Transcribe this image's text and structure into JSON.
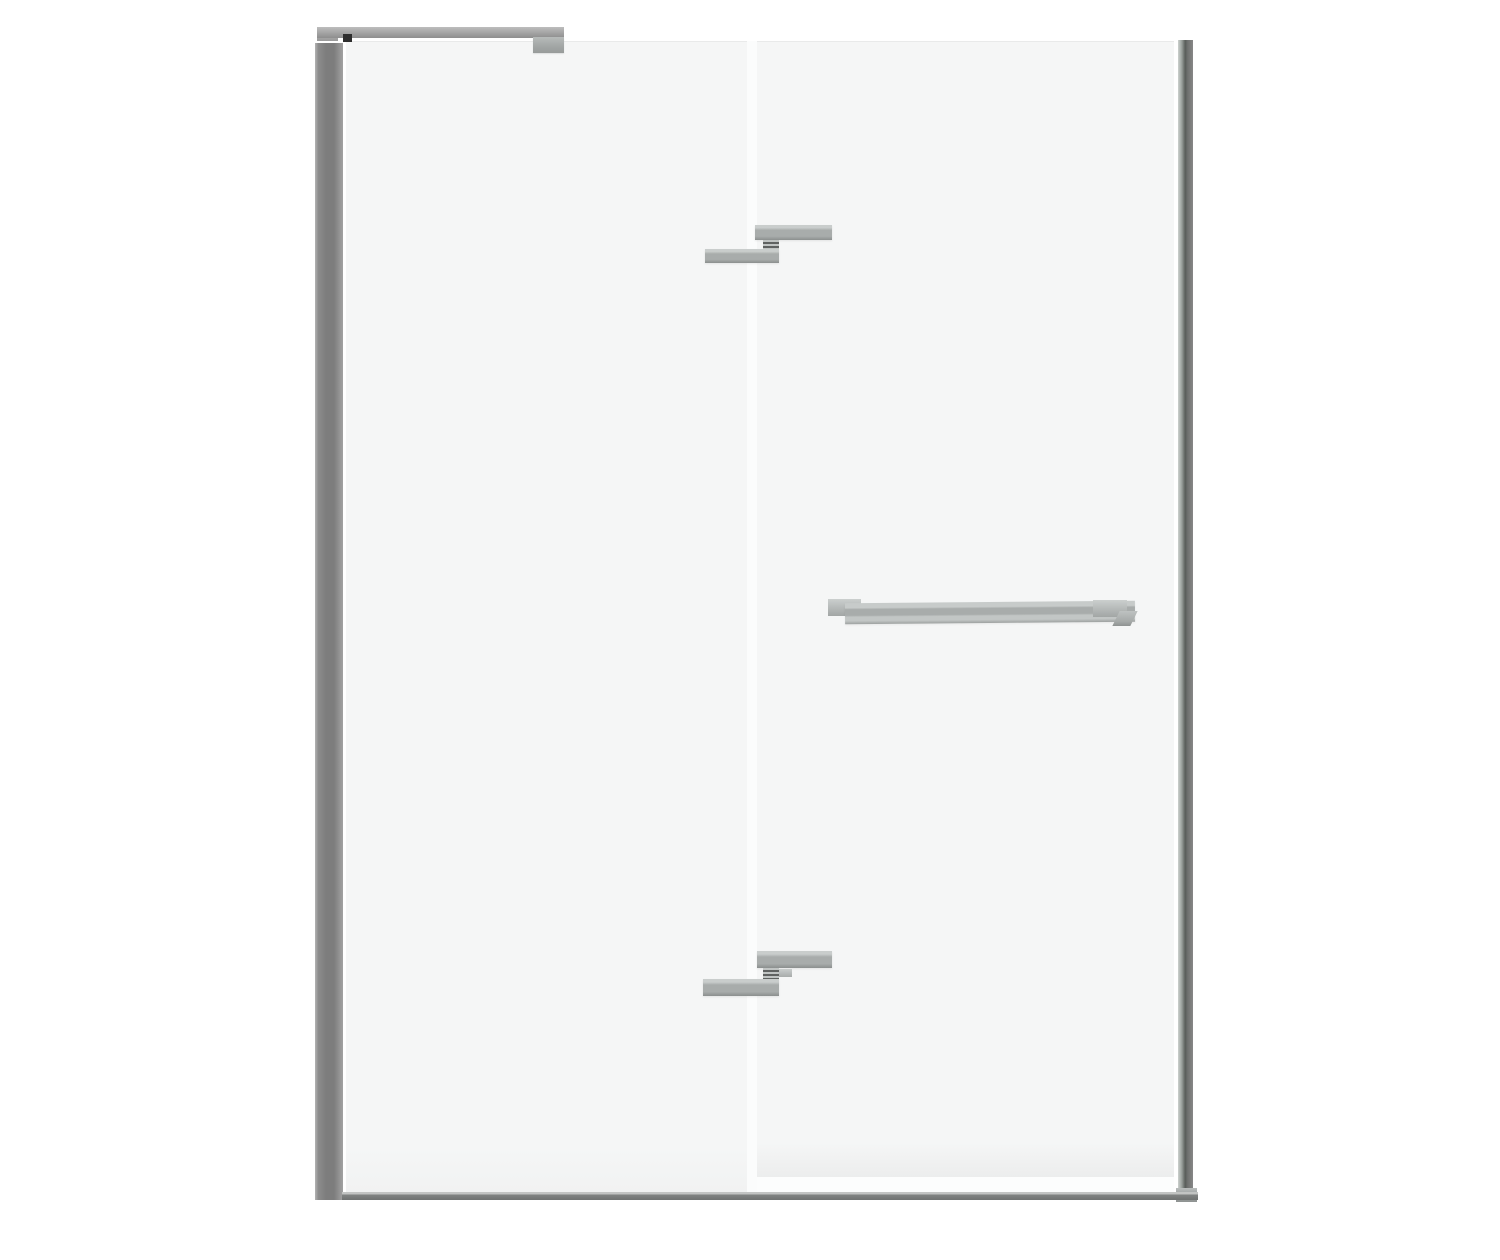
{
  "meta": {
    "kind": "product-render",
    "subject": "frameless-pivot-shower-door-with-fixed-side-panel",
    "background": "#ffffff",
    "canvas_size": "1500x1260",
    "visible_text": "none"
  },
  "palette": {
    "bg": "#ffffff",
    "glass": "#f5f6f6",
    "glass-edge": "#e9eaea",
    "seam": "#fbfcfc",
    "chrome-light": "#c9cdcc",
    "chrome-mid": "#a8acab",
    "chrome-dark": "#8b8f8e",
    "chrome-deep": "#5f6261",
    "bar-light": "#bdbdbd",
    "post-light": "#b3b3b3",
    "post-mid": "#7d7d7d",
    "post-edge": "#a2a2a2",
    "connector-dark": "#2e2e2e",
    "sill-light": "#c2c4c3",
    "sill-mid": "#7f8281",
    "profile-right-hi": "#cdd2cf",
    "profile-right-mid": "#9aa09c",
    "profile-right-dark": "#595d5a",
    "profile-right-back": "#878787"
  },
  "parts": [
    "fixed-glass-panel",
    "pivot-glass-door",
    "panel-door-seam",
    "left-wall-profile",
    "top-support-bar",
    "support-bar-wall-mount",
    "support-bar-connector",
    "support-bar-glass-clamp",
    "right-vertical-profile",
    "right-profile-foot",
    "bottom-sill",
    "top-hinge",
    "bottom-hinge",
    "towel-bar-handle"
  ]
}
